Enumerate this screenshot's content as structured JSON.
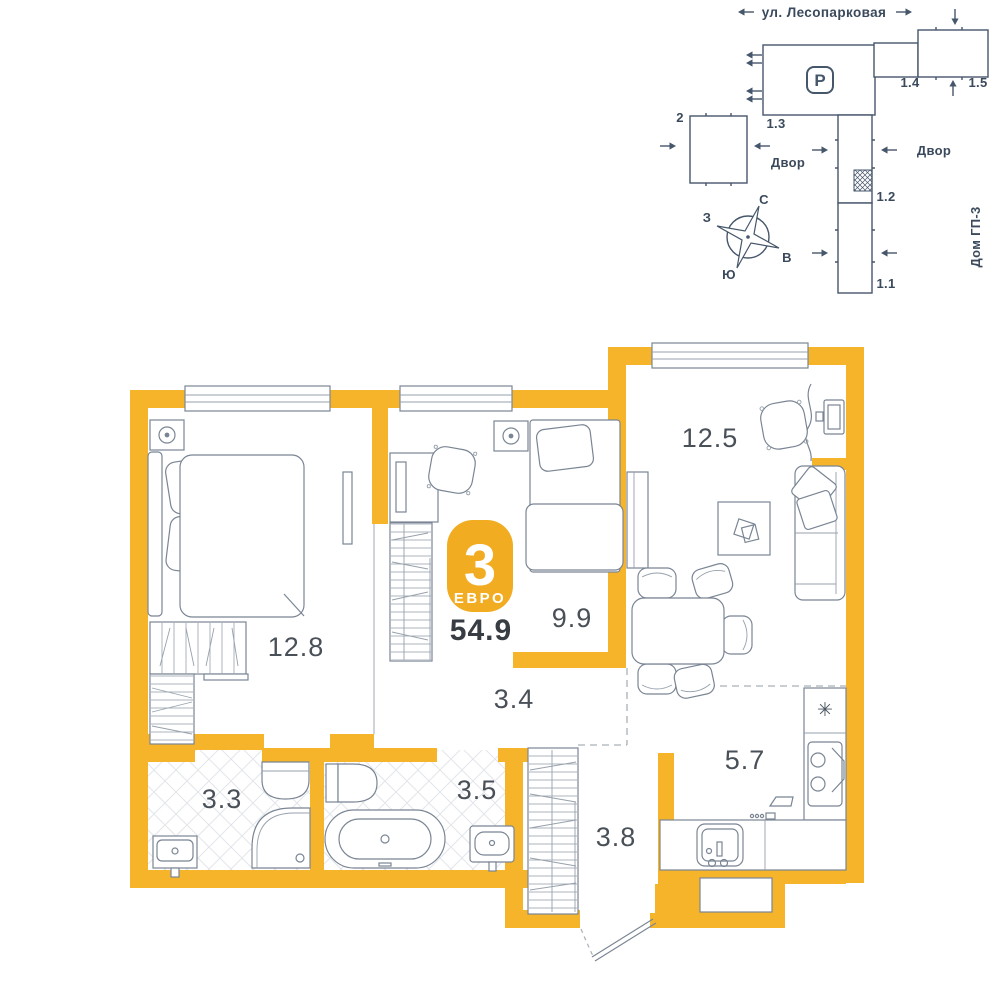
{
  "colors": {
    "wall": "#F6B42A",
    "badge": "#F1AC21",
    "furniture_line": "#7A8594",
    "site_line": "#46566B",
    "site_text": "#3A4A5C",
    "room_label": "#4A5058",
    "total_text": "#383D44",
    "zone_dash": "#A9B0B8"
  },
  "site_plan": {
    "street": "ул. Лесопарковая",
    "parking": "P",
    "yard_left": "Двор",
    "yard_right": "Двор",
    "house": "Дом ГП-3",
    "buildings": {
      "b2": "2",
      "b13": "1.3",
      "b14": "1.4",
      "b15": "1.5",
      "b12": "1.2",
      "b11": "1.1"
    },
    "compass": {
      "north": "С",
      "south": "Ю",
      "west": "З",
      "east": "В"
    }
  },
  "apartment": {
    "badge_number": "3",
    "badge_type": "ЕВРО",
    "total_area": "54.9",
    "fridge_symbol": "✳",
    "rooms": [
      {
        "name": "living-room",
        "area": "12.5"
      },
      {
        "name": "bedroom-1",
        "area": "12.8"
      },
      {
        "name": "bedroom-2",
        "area": "9.9"
      },
      {
        "name": "corridor",
        "area": "3.4"
      },
      {
        "name": "bathroom-1",
        "area": "3.3"
      },
      {
        "name": "bathroom-2",
        "area": "3.5"
      },
      {
        "name": "hallway",
        "area": "3.8"
      },
      {
        "name": "kitchen",
        "area": "5.7"
      }
    ]
  }
}
